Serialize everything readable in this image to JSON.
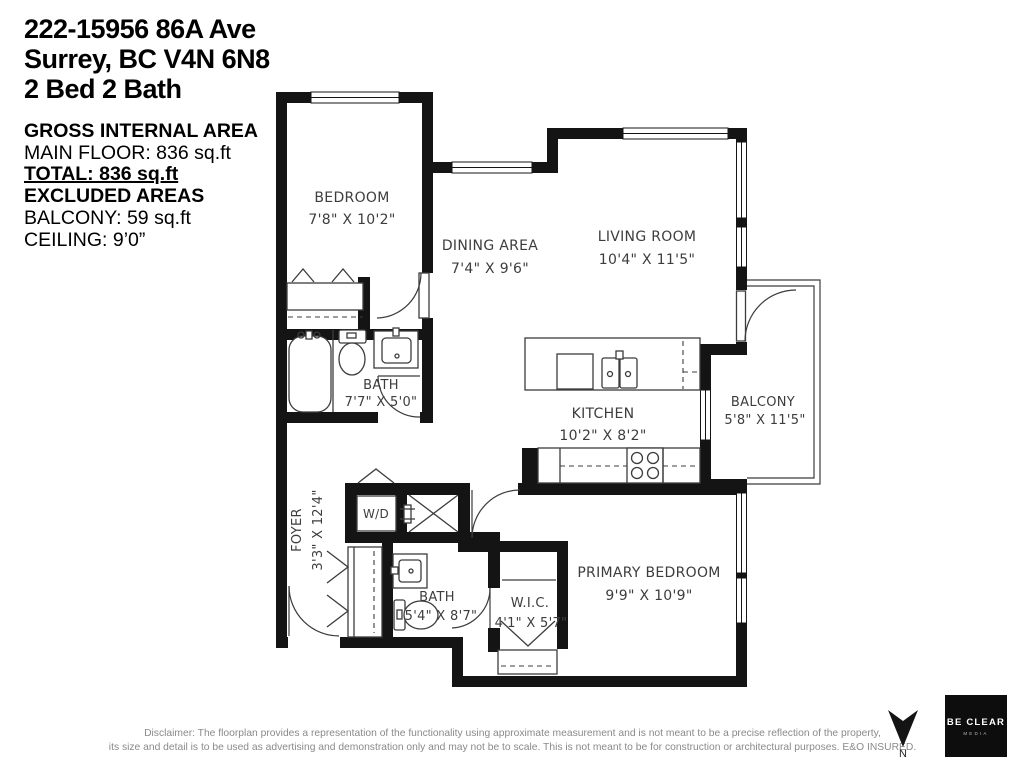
{
  "header": {
    "address_line1": "222-15956 86A Ave",
    "address_line2": "Surrey, BC V4N 6N8",
    "address_line3": "2 Bed 2 Bath"
  },
  "area_summary": {
    "title": "GROSS INTERNAL AREA",
    "main_floor": "MAIN FLOOR: 836 sq.ft",
    "total": "TOTAL: 836 sq.ft",
    "excluded_title": "EXCLUDED AREAS",
    "balcony": "BALCONY: 59 sq.ft",
    "ceiling": "CEILING: 9’0”"
  },
  "rooms": {
    "bedroom": {
      "name": "BEDROOM",
      "dims": "7'8\" X 10'2\""
    },
    "dining": {
      "name": "DINING AREA",
      "dims": "7'4\" X 9'6\""
    },
    "living": {
      "name": "LIVING ROOM",
      "dims": "10'4\" X 11'5\""
    },
    "bath1": {
      "name": "BATH",
      "dims": "7'7\" X 5'0\""
    },
    "kitchen": {
      "name": "KITCHEN",
      "dims": "10'2\" X 8'2\""
    },
    "balcony": {
      "name": "BALCONY",
      "dims": "5'8\" X 11'5\""
    },
    "foyer": {
      "name": "FOYER",
      "dims": "3'3\" X 12'4\""
    },
    "laundry": {
      "name": "W/D"
    },
    "bath2": {
      "name": "BATH",
      "dims": "5'4\" X 8'7\""
    },
    "wic": {
      "name": "W.I.C.",
      "dims": "4'1\" X 5'7\""
    },
    "primary": {
      "name": "PRIMARY BEDROOM",
      "dims": "9'9\" X 10'9\""
    }
  },
  "footer": {
    "disclaimer_line1": "Disclaimer: The floorplan provides a representation of the functionality using approximate measurement and is not meant to be a precise reflection of the property,",
    "disclaimer_line2": "its size and detail is to be used as advertising and demonstration only and may not be to scale. This is not meant to be for construction or architectural purposes. E&O INSURED.",
    "north_label": "N",
    "logo_line1": "BE CLEAR",
    "logo_line2": "MEDIA"
  },
  "colors": {
    "wall": "#141414",
    "label_text": "#3d3d3d",
    "disclaimer_text": "#8a8a8a",
    "logo_background": "#0d0d0d",
    "background": "#ffffff"
  }
}
